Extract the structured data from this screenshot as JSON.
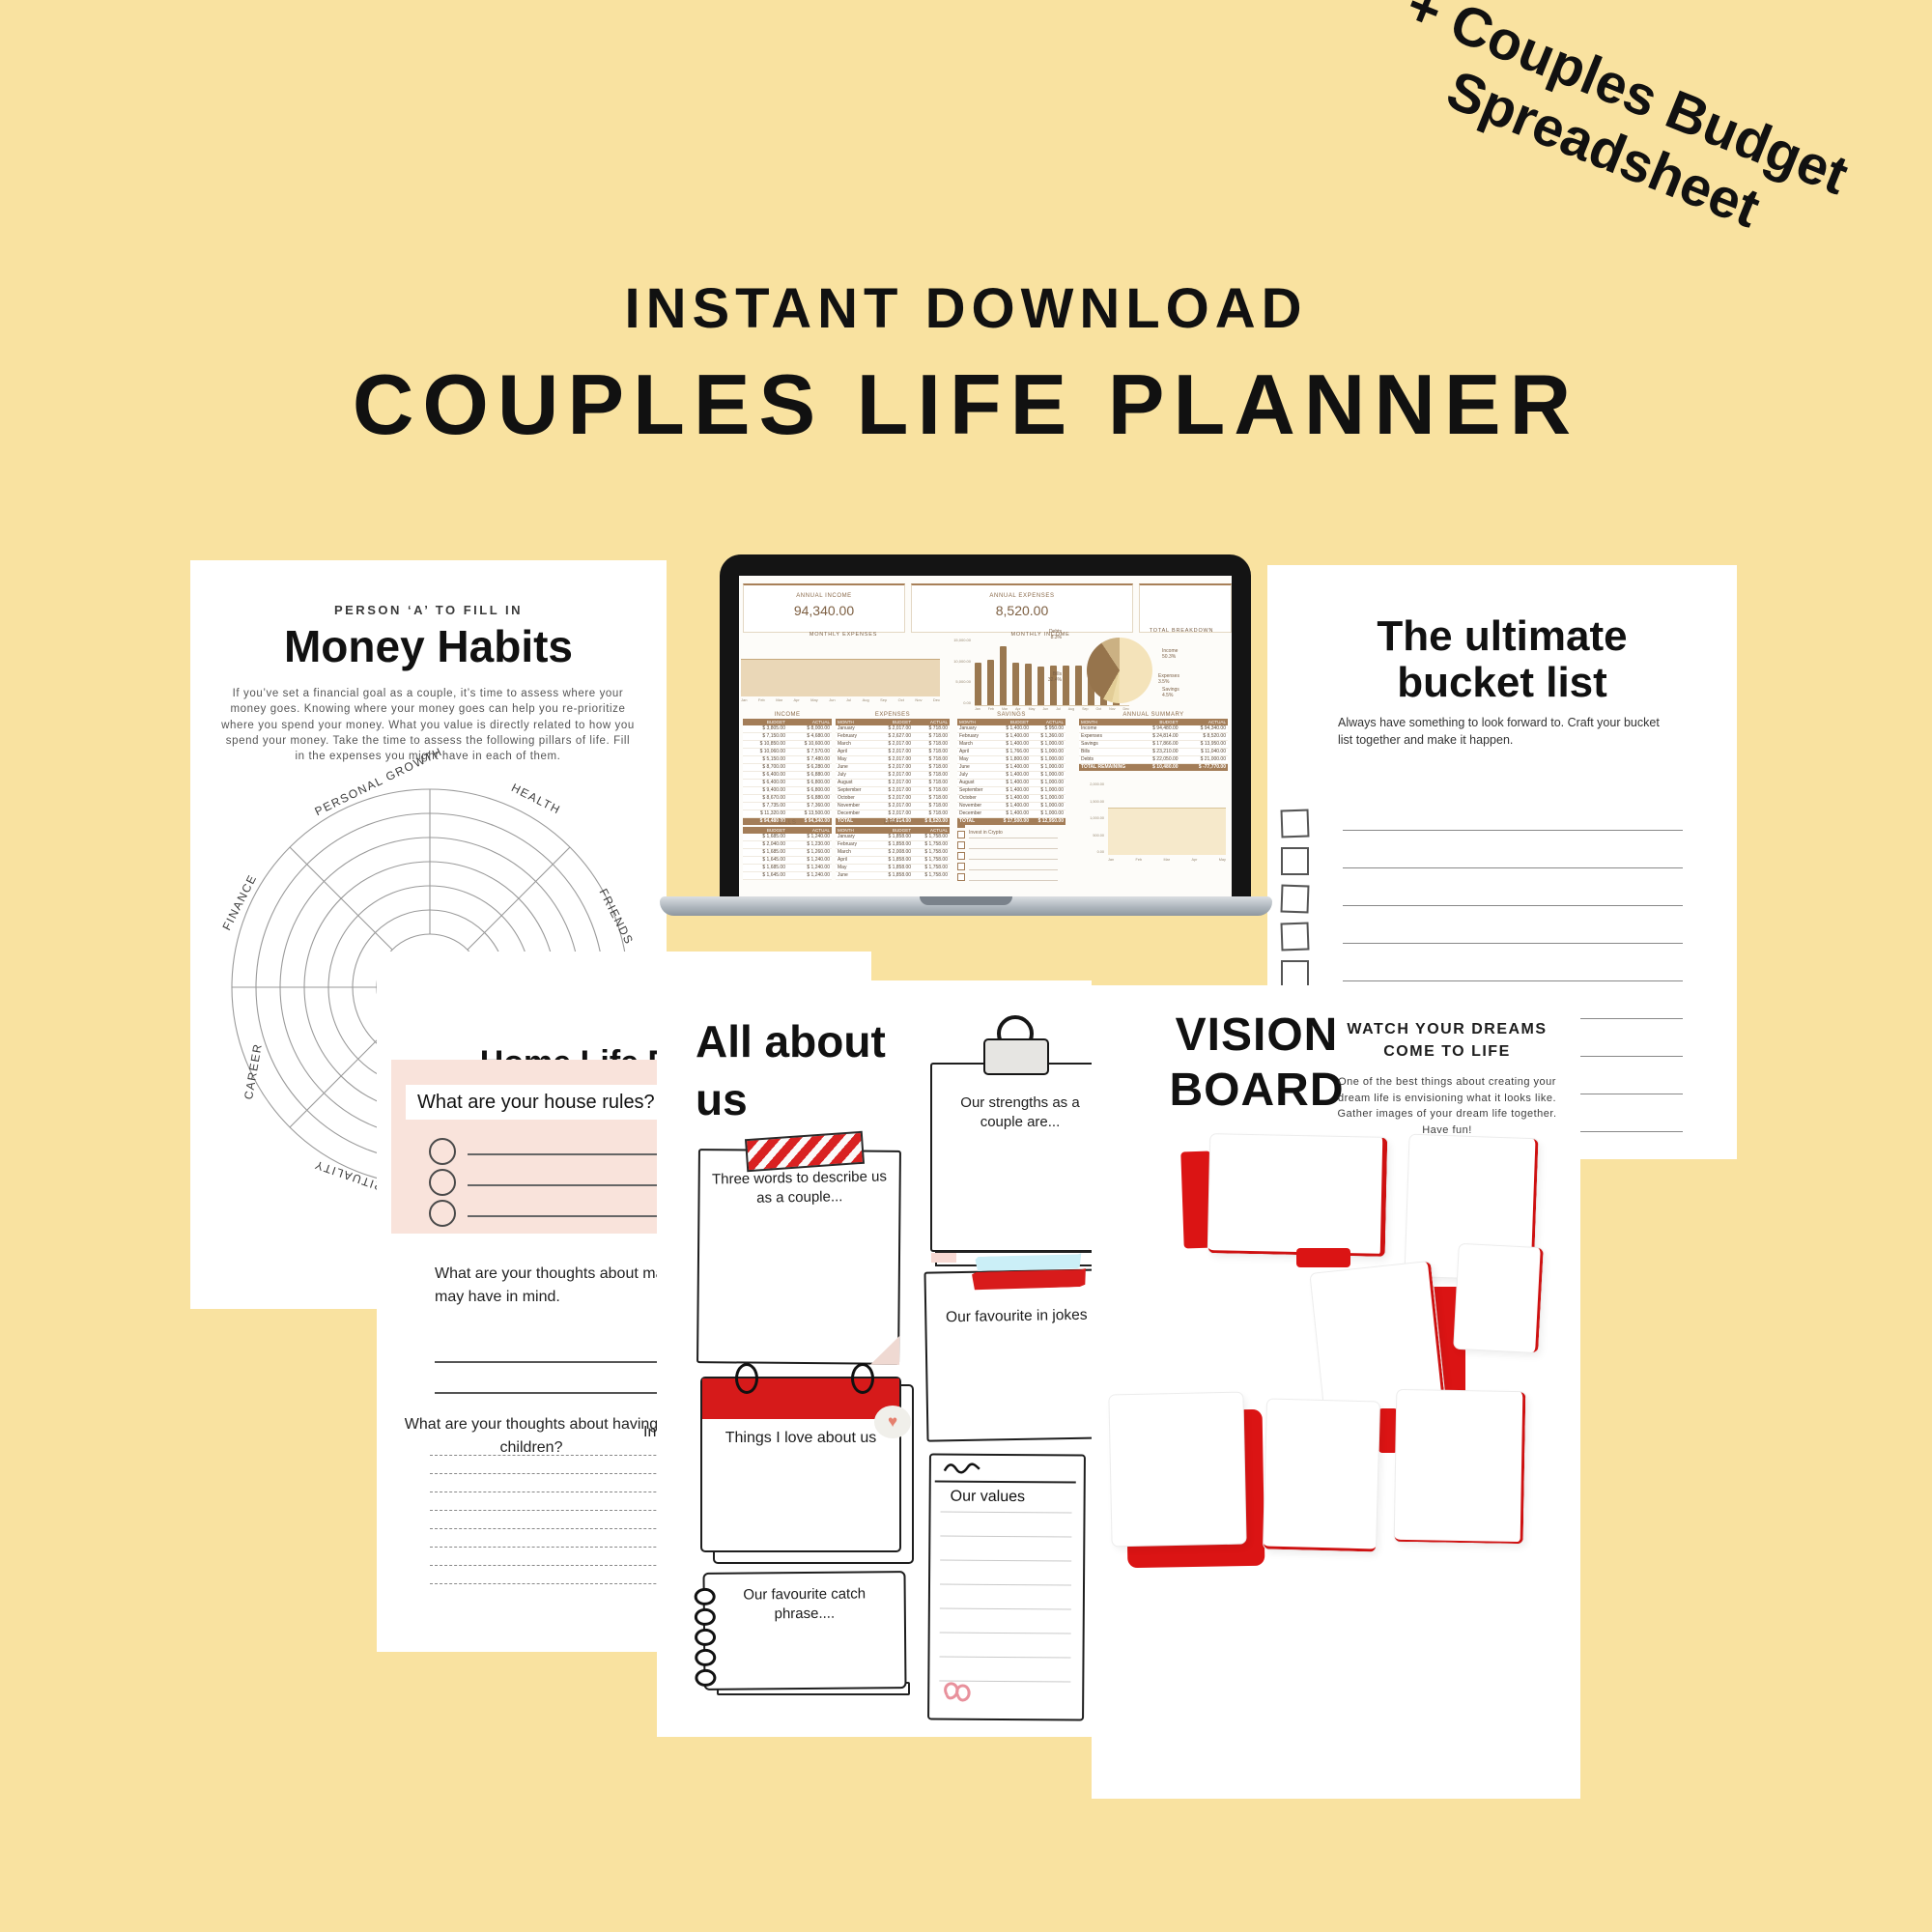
{
  "badge": {
    "line1": "+ Couples Budget",
    "line2": "Spreadsheet"
  },
  "header": {
    "kicker": "INSTANT DOWNLOAD",
    "title": "COUPLES LIFE PLANNER"
  },
  "money_habits": {
    "kicker": "PERSON ‘A’ TO FILL IN",
    "title": "Money Habits",
    "paragraph": "If you’ve set a financial goal as a couple, it’s time to assess where your money goes. Knowing where your money goes can help you re-prioritize where you spend your money. What you value is directly related to how you spend your money. Take the time to assess the following pillars of life. Fill in the expenses you might have in each of them.",
    "wheel_labels": [
      "PERSONAL GROWTH",
      "HEALTH",
      "FRIENDS",
      "FINANCE",
      "CAREER",
      "SPIRITUALITY"
    ]
  },
  "laptop": {
    "stats": [
      {
        "label": "ANNUAL INCOME",
        "value": "94,340.00"
      },
      {
        "label": "ANNUAL EXPENSES",
        "value": "8,520.00"
      }
    ],
    "charts": {
      "monthly_expenses_title": "MONTHLY EXPENSES",
      "monthly_income_title": "MONTHLY INCOME",
      "total_breakdown_title": "TOTAL BREAKDOWN",
      "months": [
        "Jan",
        "Feb",
        "Mar",
        "Apr",
        "May",
        "Jun",
        "Jul",
        "Aug",
        "Sep",
        "Oct",
        "Nov",
        "Dec"
      ],
      "income_bars": [
        7600,
        8000,
        10400,
        7500,
        7400,
        6800,
        7000,
        7000,
        7000,
        6900,
        7400,
        11300
      ],
      "bar_axis_labels": [
        "15,000.00",
        "10,000.00",
        "5,000.00",
        "0.00"
      ],
      "pie_slices": [
        {
          "label": "Income",
          "pct": 50.3,
          "pct_text": "50.3%",
          "color": "#F4E3BA"
        },
        {
          "label": "Expenses",
          "pct": 3.5,
          "pct_text": "3.5%",
          "color": "#EDDCA9"
        },
        {
          "label": "Savings",
          "pct": 4.5,
          "pct_text": "4.5%",
          "color": "#E2CD96"
        },
        {
          "label": "Bills",
          "pct": 32.4,
          "pct_text": "32.4%",
          "color": "#96744C"
        },
        {
          "label": "Debts",
          "pct": 8.3,
          "pct_text": "8.3%",
          "color": "#CBB183"
        }
      ],
      "mini_axis_labels": [
        "2,000.00",
        "1,500.00",
        "1,000.00",
        "500.00",
        "0.00"
      ],
      "mini_months": [
        "Jan",
        "Feb",
        "Mar",
        "Apr",
        "May"
      ]
    },
    "tables": [
      {
        "id": "income",
        "title": "INCOME",
        "header": [
          "BUDGET",
          "ACTUAL"
        ],
        "rows": [
          [
            "$ 3,805.00",
            "$ 8,000.00"
          ],
          [
            "$ 7,150.00",
            "$ 4,680.00"
          ],
          [
            "$ 10,850.00",
            "$ 10,600.00"
          ],
          [
            "$ 10,060.00",
            "$ 7,570.00"
          ],
          [
            "$ 5,150.00",
            "$ 7,480.00"
          ],
          [
            "$ 8,700.00",
            "$ 6,280.00"
          ],
          [
            "$ 6,400.00",
            "$ 6,880.00"
          ],
          [
            "$ 6,400.00",
            "$ 6,800.00"
          ],
          [
            "$ 9,400.00",
            "$ 6,800.00"
          ],
          [
            "$ 8,670.00",
            "$ 6,880.00"
          ],
          [
            "$ 7,735.00",
            "$ 7,360.00"
          ],
          [
            "$ 11,320.00",
            "$ 13,500.00"
          ]
        ],
        "total": [
          "$ 94,480.00",
          "$ 94,340.00"
        ]
      },
      {
        "id": "expenses",
        "title": "EXPENSES",
        "header": [
          "MONTH",
          "BUDGET",
          "ACTUAL"
        ],
        "rows": [
          [
            "January",
            "$ 2,017.00",
            "$ 718.00"
          ],
          [
            "February",
            "$ 2,627.00",
            "$ 718.00"
          ],
          [
            "March",
            "$ 2,017.00",
            "$ 718.00"
          ],
          [
            "April",
            "$ 2,017.00",
            "$ 718.00"
          ],
          [
            "May",
            "$ 2,017.00",
            "$ 718.00"
          ],
          [
            "June",
            "$ 2,017.00",
            "$ 718.00"
          ],
          [
            "July",
            "$ 2,017.00",
            "$ 718.00"
          ],
          [
            "August",
            "$ 2,017.00",
            "$ 718.00"
          ],
          [
            "September",
            "$ 2,017.00",
            "$ 718.00"
          ],
          [
            "October",
            "$ 2,017.00",
            "$ 718.00"
          ],
          [
            "November",
            "$ 2,017.00",
            "$ 718.00"
          ],
          [
            "December",
            "$ 2,017.00",
            "$ 718.00"
          ]
        ],
        "total": [
          "TOTAL",
          "$ 24,814.00",
          "$ 8,520.00"
        ]
      },
      {
        "id": "savings",
        "title": "SAVINGS",
        "header": [
          "MONTH",
          "BUDGET",
          "ACTUAL"
        ],
        "rows": [
          [
            "January",
            "$ 1,400.00",
            "$ 950.00"
          ],
          [
            "February",
            "$ 1,400.00",
            "$ 1,360.00"
          ],
          [
            "March",
            "$ 1,400.00",
            "$ 1,000.00"
          ],
          [
            "April",
            "$ 1,766.00",
            "$ 1,000.00"
          ],
          [
            "May",
            "$ 1,800.00",
            "$ 1,000.00"
          ],
          [
            "June",
            "$ 1,400.00",
            "$ 1,000.00"
          ],
          [
            "July",
            "$ 1,400.00",
            "$ 1,000.00"
          ],
          [
            "August",
            "$ 1,400.00",
            "$ 1,000.00"
          ],
          [
            "September",
            "$ 1,400.00",
            "$ 1,000.00"
          ],
          [
            "October",
            "$ 1,400.00",
            "$ 1,000.00"
          ],
          [
            "November",
            "$ 1,400.00",
            "$ 1,000.00"
          ],
          [
            "December",
            "$ 1,400.00",
            "$ 1,000.00"
          ]
        ],
        "total": [
          "TOTAL",
          "$ 17,500.00",
          "$ 12,950.00"
        ]
      },
      {
        "id": "annual",
        "title": "ANNUAL SUMMARY",
        "header": [
          "MONTH",
          "BUDGET",
          "ACTUAL"
        ],
        "rows": [
          [
            "Income",
            "$ 94,480.00",
            "$ 94,340.00"
          ],
          [
            "Expenses",
            "$ 24,814.00",
            "$ 8,520.00"
          ],
          [
            "Savings",
            "$ 17,866.00",
            "$ 13,950.00"
          ],
          [
            "Bills",
            "$ 23,210.00",
            "$ 11,040.00"
          ],
          [
            "Debts",
            "$ 22,050.00",
            "$ 21,000.00"
          ]
        ],
        "total": [
          "TOTAL REMAINING",
          "$ 10,480.00",
          "$ -77,770.00"
        ]
      },
      {
        "id": "bills",
        "title": "BILLS",
        "header": [
          "BUDGET",
          "ACTUAL"
        ],
        "rows": [
          [
            "$ 1,685.00",
            "$ 1,240.00"
          ],
          [
            "$ 2,040.00",
            "$ 1,230.00"
          ],
          [
            "$ 1,685.00",
            "$ 1,260.00"
          ],
          [
            "$ 1,645.00",
            "$ 1,240.00"
          ],
          [
            "$ 1,685.00",
            "$ 1,240.00"
          ],
          [
            "$ 1,645.00",
            "$ 1,240.00"
          ]
        ],
        "total": null
      },
      {
        "id": "debt",
        "title": "DEBT",
        "header": [
          "MONTH",
          "BUDGET",
          "ACTUAL"
        ],
        "rows": [
          [
            "January",
            "$ 1,858.00",
            "$ 1,758.00"
          ],
          [
            "February",
            "$ 1,858.00",
            "$ 1,758.00"
          ],
          [
            "March",
            "$ 2,008.00",
            "$ 1,758.00"
          ],
          [
            "April",
            "$ 1,858.00",
            "$ 1,758.00"
          ],
          [
            "May",
            "$ 1,858.00",
            "$ 1,758.00"
          ],
          [
            "June",
            "$ 1,858.00",
            "$ 1,758.00"
          ]
        ],
        "total": null
      }
    ],
    "goals": {
      "title": "FINANCIAL GOALS",
      "first_item": "Invest in Crypto",
      "empty_rows": 4
    }
  },
  "bucket_list": {
    "title_line1": "The ultimate",
    "title_line2": "bucket list",
    "subtitle": "Always have something to look forward to. Craft your bucket list together and make it happen.",
    "checklist_rows": 9
  },
  "home_life": {
    "title": "Home Life Planner",
    "q1": "What are your house rules?",
    "q2_line1": "What are your thoughts about marriage",
    "q2_line2": "may have in mind.",
    "q3": "What are your thoughts about having children?",
    "q4_partial": "In",
    "dashed_rows": 8
  },
  "all_about_us": {
    "title_line1": "All about",
    "title_line2": "us",
    "note_three_words": "Three words to describe us as a couple...",
    "note_strengths": "Our strengths as a couple are...",
    "note_jokes": "Our favourite in jokes",
    "note_love": "Things I love about us",
    "note_catch_line1": "Our favourite catch",
    "note_catch_line2": "phrase....",
    "note_values": "Our values"
  },
  "vision_board": {
    "title_line1": "VISION",
    "title_line2": "BOARD",
    "heading": "WATCH YOUR DREAMS COME TO LIFE",
    "paragraph": "One of the best things about creating your dream life is envisioning what it looks like. Gather images of your dream life together. Have fun!"
  }
}
